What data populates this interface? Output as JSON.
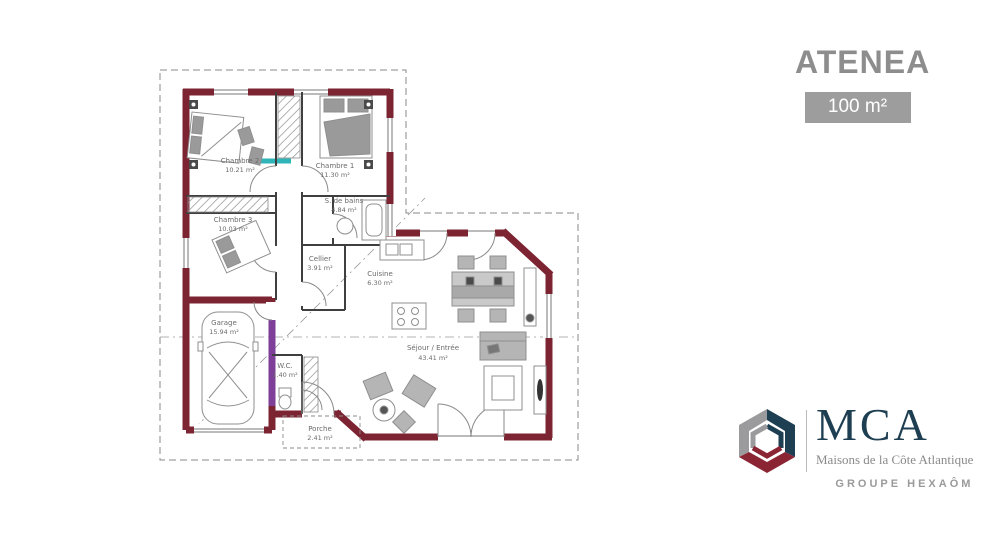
{
  "header": {
    "title": "ATENEA",
    "area_badge": "100 m²"
  },
  "plan": {
    "rooms": [
      {
        "name": "Chambre 2",
        "area": "10.21 m²"
      },
      {
        "name": "Chambre 1",
        "area": "11.30 m²"
      },
      {
        "name": "S. de bains",
        "area": "4.84 m²"
      },
      {
        "name": "Chambre 3",
        "area": "10.03 m²"
      },
      {
        "name": "Cellier",
        "area": "3.91 m²"
      },
      {
        "name": "Cuisine",
        "area": "6.30 m²"
      },
      {
        "name": "Garage",
        "area": "15.94 m²"
      },
      {
        "name": "W.C.",
        "area": "1.40 m²"
      },
      {
        "name": "Séjour / Entrée",
        "area": "43.41 m²"
      },
      {
        "name": "Porche",
        "area": "2.41 m²"
      }
    ],
    "colors": {
      "wall": "#7d2433",
      "accent_teal": "#2fb4b8",
      "accent_purple": "#7d3f98",
      "interior_line": "#3f3f3f",
      "dashed_line": "#8a8a8a"
    }
  },
  "brand": {
    "name": "MCA",
    "tagline": "Maisons de la Côte Atlantique",
    "group": "GROUPE HEXAÔM",
    "colors": {
      "blue": "#1e3e52",
      "red": "#8b2433",
      "gray": "#9b9b9e",
      "title_gray": "#8d8d8d",
      "badge_bg": "#9d9d9d"
    }
  }
}
